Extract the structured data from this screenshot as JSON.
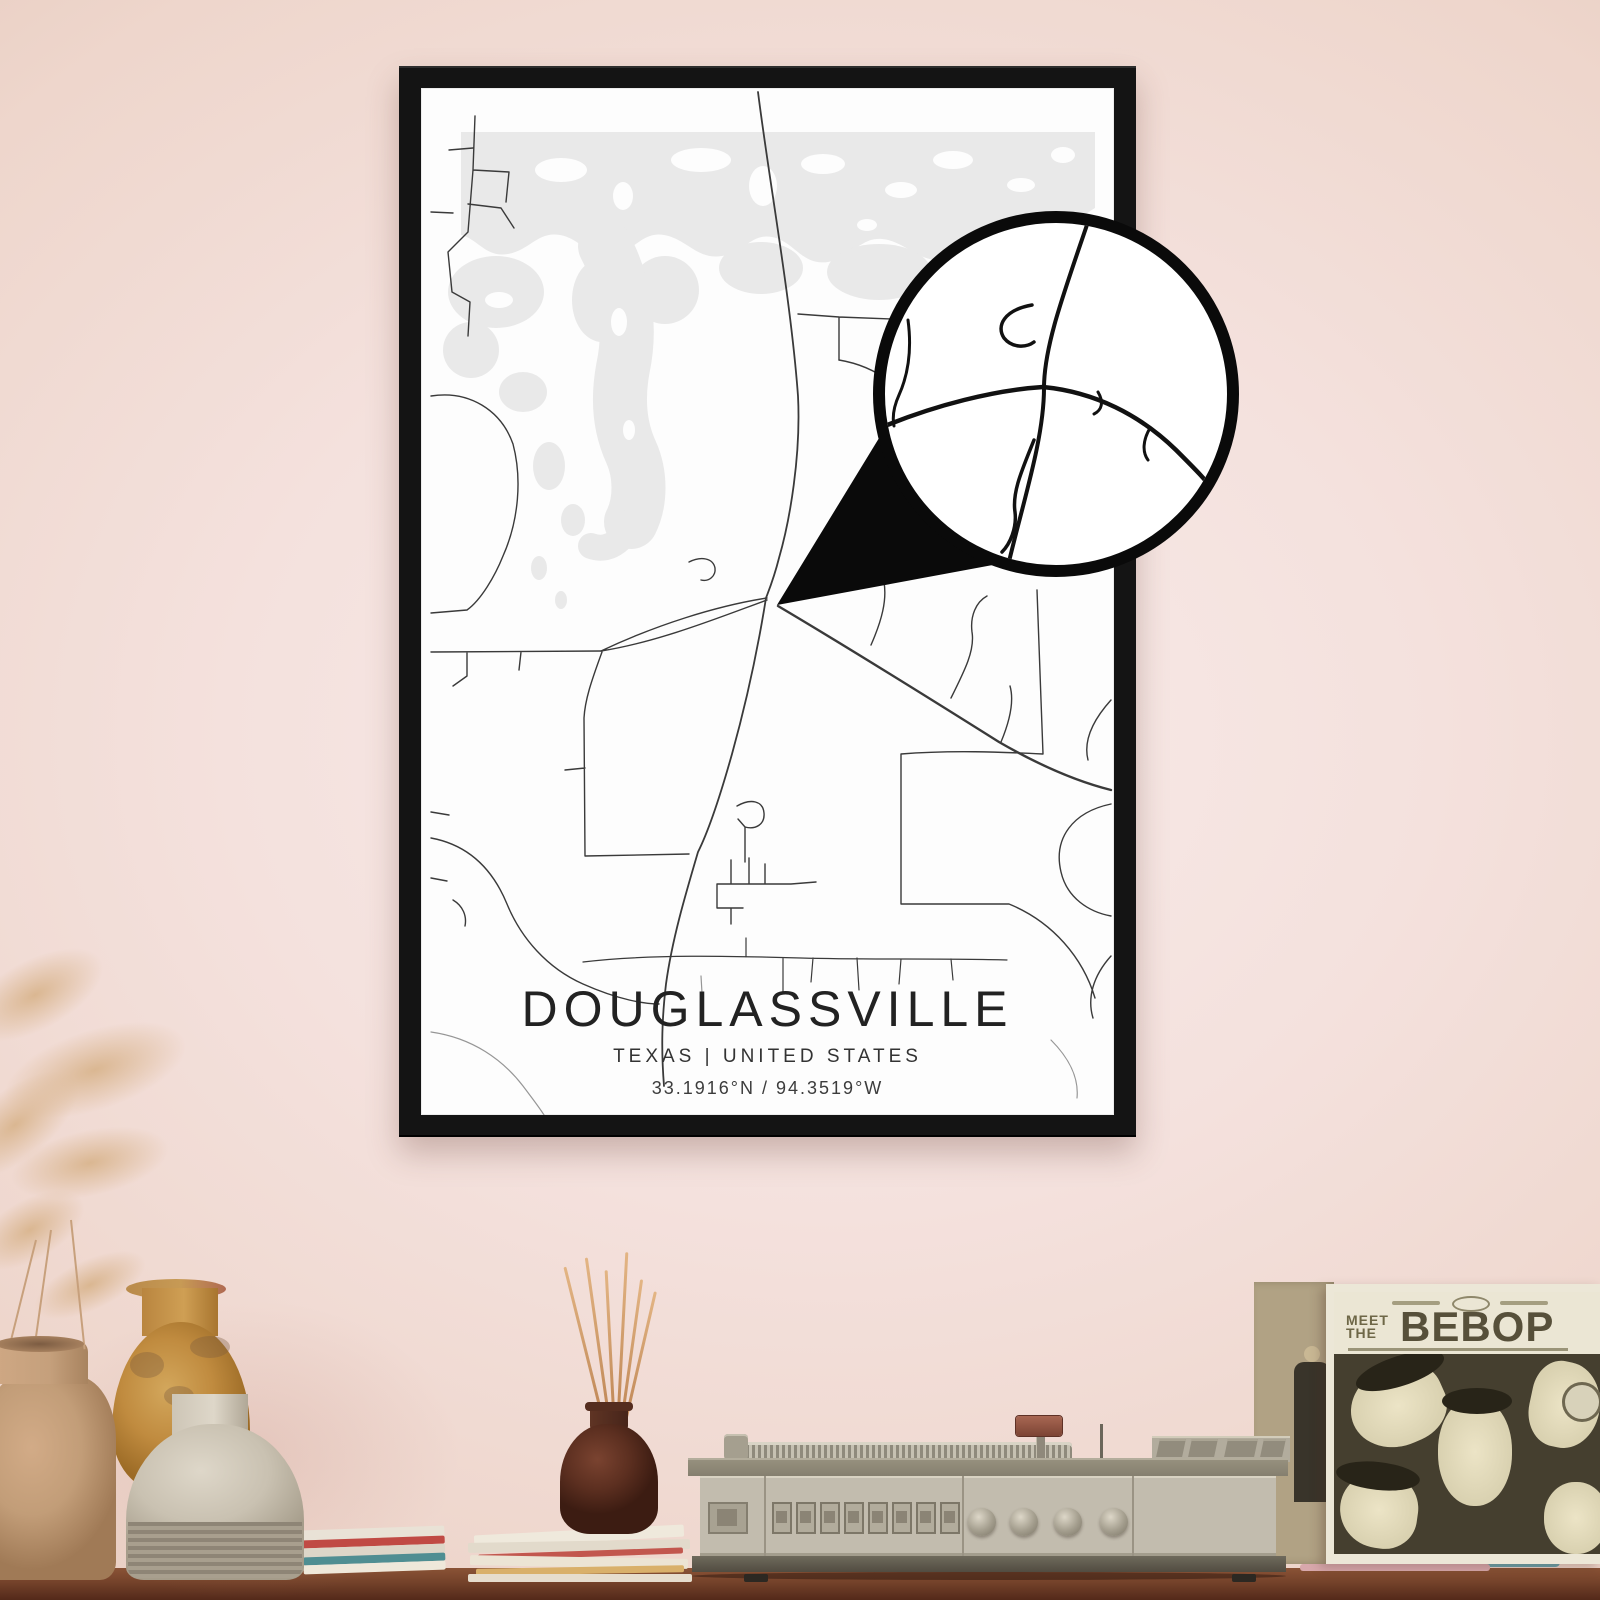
{
  "poster": {
    "title": "DOUGLASSVILLE",
    "subtitle": "TEXAS | UNITED STATES",
    "coordinates": "33.1916°N / 94.3519°W",
    "frame_color": "#141414",
    "paper_color": "#fdfdfd",
    "water_color": "#e9e9e9",
    "road_color": "#3a3a3a"
  },
  "magnifier": {
    "ring_color": "#0a0a0a",
    "fill_color": "#ffffff"
  },
  "record_sleeve": {
    "pretitle_line1": "MEET",
    "pretitle_line2": "THE",
    "title": "BEBOP",
    "art_background": "#453f2f"
  },
  "scene": {
    "wall_color": "#f2dcd6",
    "table_color": "#74422a"
  }
}
